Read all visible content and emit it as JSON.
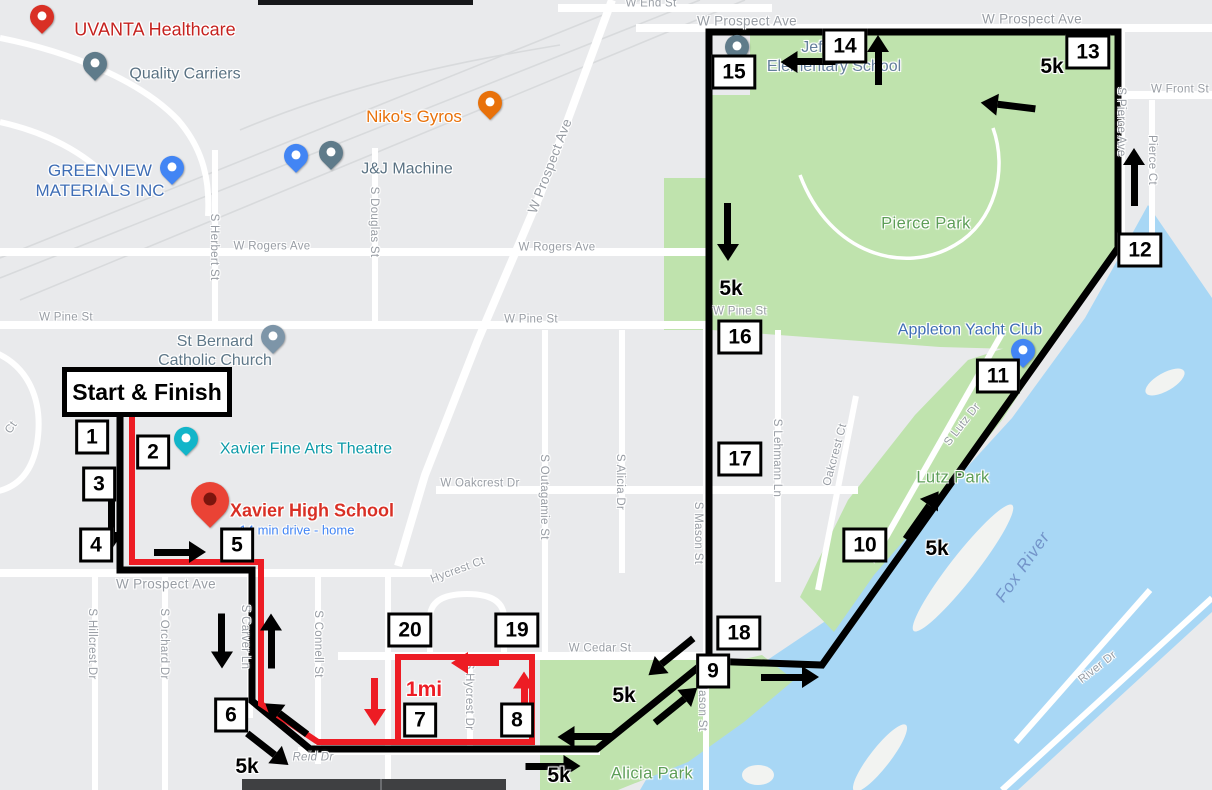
{
  "map": {
    "colors": {
      "background": "#e9eaec",
      "road": "#ffffff",
      "park_green": "#bfe3ad",
      "water_blue": "#a8d7f5",
      "route_black": "#000000",
      "route_red": "#ed1c24",
      "marker_bg": "#ffffff",
      "marker_border": "#000000",
      "street_label": "#989da4",
      "park_label_green": "#5d9e57",
      "water_label_blue": "#7394c9",
      "rail": "#d8dadc"
    },
    "start_finish": {
      "label": "Start & Finish"
    },
    "street_labels": [
      {
        "t": "W End St",
        "x": 651,
        "y": 4
      },
      {
        "t": "W Prospect Ave",
        "x": 747,
        "y": 21,
        "s": 13.5
      },
      {
        "t": "W Prospect Ave",
        "x": 1032,
        "y": 19,
        "s": 13.5
      },
      {
        "t": "W Front St",
        "x": 1180,
        "y": 90
      },
      {
        "t": "Pierce Ct",
        "x": 1151,
        "y": 160,
        "r": 90
      },
      {
        "t": "S Pierce Ave",
        "x": 1120,
        "y": 122,
        "r": 90
      },
      {
        "t": "W Rogers Ave",
        "x": 272,
        "y": 247
      },
      {
        "t": "W Rogers Ave",
        "x": 557,
        "y": 248
      },
      {
        "t": "S Herbert St",
        "x": 213,
        "y": 247,
        "r": 90
      },
      {
        "t": "S Douglas St",
        "x": 373,
        "y": 222,
        "r": 90
      },
      {
        "t": "W Prospect Ave",
        "x": 550,
        "y": 166,
        "r": -69,
        "s": 13.5
      },
      {
        "t": "W Pine St",
        "x": 66,
        "y": 318
      },
      {
        "t": "W Pine St",
        "x": 531,
        "y": 320
      },
      {
        "t": "W Pine St",
        "x": 740,
        "y": 312
      },
      {
        "t": "W Oakcrest Dr",
        "x": 480,
        "y": 484
      },
      {
        "t": "S Outagamie St",
        "x": 543,
        "y": 497,
        "r": 90
      },
      {
        "t": "S Alicia Dr",
        "x": 619,
        "y": 482,
        "r": 90
      },
      {
        "t": "S Mason St",
        "x": 697,
        "y": 533,
        "r": 90
      },
      {
        "t": "S Mason St",
        "x": 701,
        "y": 700,
        "r": 90
      },
      {
        "t": "S Lehmann Ln",
        "x": 776,
        "y": 458,
        "r": 90
      },
      {
        "t": "Oakcrest Ct",
        "x": 836,
        "y": 455,
        "r": -75
      },
      {
        "t": "S Lutz Dr",
        "x": 963,
        "y": 425,
        "r": -52
      },
      {
        "t": "River Dr",
        "x": 1098,
        "y": 668,
        "r": -38
      },
      {
        "t": "Hycrest Ct",
        "x": 458,
        "y": 571,
        "r": -20
      },
      {
        "t": "S Hycrest Dr",
        "x": 468,
        "y": 696,
        "r": 90
      },
      {
        "t": "W Prospect Ave",
        "x": 166,
        "y": 584,
        "s": 13.5
      },
      {
        "t": "S Hillcrest Dr",
        "x": 91,
        "y": 644,
        "r": 90
      },
      {
        "t": "S Orchard Dr",
        "x": 163,
        "y": 644,
        "r": 90
      },
      {
        "t": "S Carver Ln",
        "x": 244,
        "y": 637,
        "r": 90
      },
      {
        "t": "S Connell St",
        "x": 317,
        "y": 644,
        "r": 90
      },
      {
        "t": "W Cedar St",
        "x": 600,
        "y": 649
      },
      {
        "t": "Reid Dr",
        "x": 313,
        "y": 758,
        "i": true
      },
      {
        "t": "Ct",
        "x": 12,
        "y": 428,
        "r": -55
      }
    ],
    "poi_labels": [
      {
        "name": "uvanta-healthcare-label",
        "lines": [
          "UVANTA Healthcare"
        ],
        "x": 155,
        "y": 30,
        "c": "#c5221f",
        "s": 18
      },
      {
        "name": "quality-carriers-label",
        "lines": [
          "Quality Carriers"
        ],
        "x": 185,
        "y": 75,
        "c": "#5a7283",
        "s": 16
      },
      {
        "name": "greenview-materials-label",
        "lines": [
          "GREENVIEW",
          "MATERIALS INC"
        ],
        "x": 100,
        "y": 181,
        "c": "#3e6db5",
        "s": 17
      },
      {
        "name": "jj-machine-label",
        "lines": [
          "J&J Machine"
        ],
        "x": 407,
        "y": 170,
        "c": "#5a7283",
        "s": 16
      },
      {
        "name": "nikos-gyros-label",
        "lines": [
          "Niko's Gyros"
        ],
        "x": 414,
        "y": 117,
        "c": "#e8710a",
        "s": 17
      },
      {
        "name": "st-bernard-label",
        "lines": [
          "St Bernard",
          "Catholic Church"
        ],
        "x": 215,
        "y": 352,
        "c": "#5f7889",
        "s": 16
      },
      {
        "name": "xavier-theatre-label",
        "lines": [
          "Xavier Fine Arts Theatre"
        ],
        "x": 306,
        "y": 450,
        "c": "#0d9aa8",
        "s": 16
      },
      {
        "name": "xavier-high-school-label",
        "lines": [
          "Xavier High School"
        ],
        "x": 312,
        "y": 511,
        "c": "#d93025",
        "s": 18,
        "w": 700
      },
      {
        "name": "xavier-drive-time-label",
        "lines": [
          "14 min drive - home"
        ],
        "x": 297,
        "y": 530,
        "c": "#4285f4",
        "s": 13
      },
      {
        "name": "jefferson-school-label",
        "lines": [
          "Jefferson",
          "Elementary School"
        ],
        "x": 834,
        "y": 58,
        "c": "#647f9c",
        "s": 16
      },
      {
        "name": "yacht-club-label",
        "lines": [
          "Appleton Yacht Club"
        ],
        "x": 970,
        "y": 331,
        "c": "#3e6db5",
        "s": 16
      }
    ],
    "park_labels": [
      {
        "t": "Pierce Park",
        "x": 926,
        "y": 224
      },
      {
        "t": "Lutz Park",
        "x": 953,
        "y": 478
      },
      {
        "t": "Alicia Park",
        "x": 652,
        "y": 774
      }
    ],
    "water_label": {
      "t": "Fox River",
      "x": 1023,
      "y": 567,
      "r": -55
    },
    "route_markers": [
      {
        "n": "1",
        "x": 92,
        "y": 437
      },
      {
        "n": "2",
        "x": 153,
        "y": 452
      },
      {
        "n": "3",
        "x": 99,
        "y": 484
      },
      {
        "n": "4",
        "x": 96,
        "y": 545
      },
      {
        "n": "5",
        "x": 237,
        "y": 545
      },
      {
        "n": "6",
        "x": 231,
        "y": 715
      },
      {
        "n": "7",
        "x": 420,
        "y": 720
      },
      {
        "n": "8",
        "x": 517,
        "y": 720
      },
      {
        "n": "9",
        "x": 713,
        "y": 671
      },
      {
        "n": "10",
        "x": 865,
        "y": 545
      },
      {
        "n": "11",
        "x": 998,
        "y": 376
      },
      {
        "n": "12",
        "x": 1140,
        "y": 250
      },
      {
        "n": "13",
        "x": 1088,
        "y": 52
      },
      {
        "n": "14",
        "x": 845,
        "y": 46
      },
      {
        "n": "15",
        "x": 734,
        "y": 72
      },
      {
        "n": "16",
        "x": 740,
        "y": 337
      },
      {
        "n": "17",
        "x": 740,
        "y": 459
      },
      {
        "n": "18",
        "x": 739,
        "y": 633
      },
      {
        "n": "19",
        "x": 517,
        "y": 630
      },
      {
        "n": "20",
        "x": 410,
        "y": 630
      }
    ],
    "distance_labels": [
      {
        "t": "5k",
        "x": 1052,
        "y": 67
      },
      {
        "t": "5k",
        "x": 731,
        "y": 289
      },
      {
        "t": "5k",
        "x": 937,
        "y": 549
      },
      {
        "t": "5k",
        "x": 624,
        "y": 696
      },
      {
        "t": "5k",
        "x": 559,
        "y": 776
      },
      {
        "t": "5k",
        "x": 247,
        "y": 767
      },
      {
        "t": "1mi",
        "x": 424,
        "y": 690,
        "c": "#ed1c24"
      }
    ],
    "arrows": [
      {
        "x": 112,
        "y": 525,
        "a": 90,
        "l": 48,
        "c": "black"
      },
      {
        "x": 180,
        "y": 552,
        "a": 0,
        "l": 52,
        "c": "black"
      },
      {
        "x": 222,
        "y": 641,
        "a": 90,
        "l": 55,
        "c": "black"
      },
      {
        "x": 271,
        "y": 641,
        "a": -90,
        "l": 55,
        "c": "black"
      },
      {
        "x": 286,
        "y": 719,
        "a": 217,
        "l": 52,
        "c": "black"
      },
      {
        "x": 268,
        "y": 749,
        "a": 38,
        "l": 52,
        "c": "black"
      },
      {
        "x": 585,
        "y": 737,
        "a": 180,
        "l": 55,
        "c": "black"
      },
      {
        "x": 553,
        "y": 766,
        "a": 0,
        "l": 55,
        "c": "black"
      },
      {
        "x": 671,
        "y": 657,
        "a": 141,
        "l": 58,
        "c": "black"
      },
      {
        "x": 676,
        "y": 705,
        "a": -39,
        "l": 55,
        "c": "black"
      },
      {
        "x": 790,
        "y": 677,
        "a": 0,
        "l": 58,
        "c": "black"
      },
      {
        "x": 922,
        "y": 515,
        "a": -55,
        "l": 58,
        "c": "black"
      },
      {
        "x": 1134,
        "y": 177,
        "a": -90,
        "l": 58,
        "c": "black"
      },
      {
        "x": 1008,
        "y": 106,
        "a": 187,
        "l": 55,
        "c": "black"
      },
      {
        "x": 878,
        "y": 60,
        "a": -90,
        "l": 50,
        "c": "black"
      },
      {
        "x": 808,
        "y": 62,
        "a": 180,
        "l": 55,
        "c": "black"
      },
      {
        "x": 728,
        "y": 232,
        "a": 90,
        "l": 58,
        "c": "black"
      },
      {
        "x": 375,
        "y": 702,
        "a": 90,
        "l": 48,
        "c": "red"
      },
      {
        "x": 475,
        "y": 663,
        "a": 180,
        "l": 48,
        "c": "red"
      },
      {
        "x": 524,
        "y": 694,
        "a": -90,
        "l": 45,
        "c": "red"
      }
    ],
    "pins": [
      {
        "name": "uvanta-healthcare-pin",
        "x": 42,
        "y": 27,
        "c": "#d93025"
      },
      {
        "name": "quality-carriers-pin",
        "x": 95,
        "y": 74,
        "c": "#5f7b8a"
      },
      {
        "name": "greenview-materials-pin",
        "x": 172,
        "y": 178,
        "c": "#4285f4"
      },
      {
        "name": "jj-shopping-pin",
        "x": 296,
        "y": 166,
        "c": "#4285f4"
      },
      {
        "name": "jj-machine-pin",
        "x": 331,
        "y": 163,
        "c": "#5f7b8a"
      },
      {
        "name": "nikos-gyros-pin",
        "x": 490,
        "y": 113,
        "c": "#e8710a"
      },
      {
        "name": "st-bernard-church-pin",
        "x": 273,
        "y": 347,
        "c": "#7d95a8"
      },
      {
        "name": "xavier-theatre-pin",
        "x": 186,
        "y": 449,
        "c": "#12b5c9"
      },
      {
        "name": "xavier-high-school-pin",
        "x": 210,
        "y": 517,
        "c": "#ea4335",
        "big": true
      },
      {
        "name": "jefferson-school-pin",
        "x": 737,
        "y": 57,
        "c": "#5f7b8a"
      },
      {
        "name": "yacht-club-pin",
        "x": 1023,
        "y": 361,
        "c": "#4285f4"
      }
    ]
  }
}
